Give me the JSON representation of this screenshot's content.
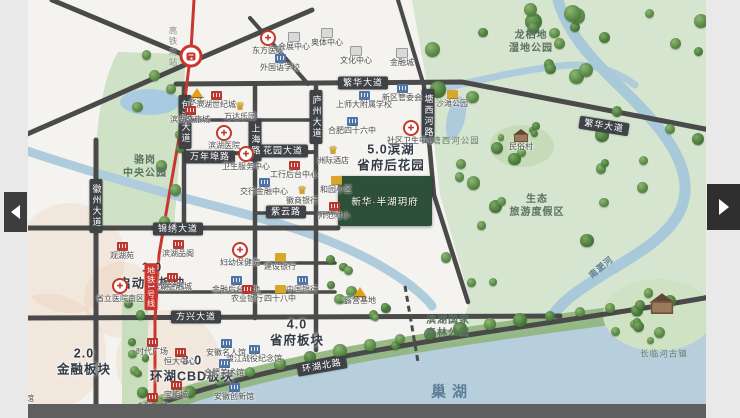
{
  "carousel": {
    "prev_name": "previous-slide",
    "next_name": "next-slide"
  },
  "colors": {
    "road": "#4a4a4a",
    "metro": "#c9362e",
    "water": "#b7cfdd",
    "park": "#d6e5cf",
    "plate": "#3f4347",
    "accent_red": "#b9372c"
  },
  "map": {
    "metro": {
      "station_label": "高铁南站",
      "station_x": 191,
      "station_y": 56,
      "label_x": 173,
      "label_y": 26,
      "line_badge": "地铁1号线",
      "badge_x": 151,
      "badge_y": 287
    },
    "project": {
      "name": "新华·半湖玥府"
    },
    "road_labels": [
      {
        "text": "繁华大道",
        "x": 363,
        "y": 83,
        "vert": false,
        "rot": 0
      },
      {
        "text": "繁华大道",
        "x": 604,
        "y": 126,
        "vert": false,
        "rot": 9
      },
      {
        "text": "锦绣大道",
        "x": 178,
        "y": 229,
        "vert": false,
        "rot": 0
      },
      {
        "text": "方兴大道",
        "x": 196,
        "y": 317,
        "vert": false,
        "rot": 0
      },
      {
        "text": "万年埠路",
        "x": 210,
        "y": 157,
        "vert": false,
        "rot": 0
      },
      {
        "text": "花园大道",
        "x": 283,
        "y": 151,
        "vert": false,
        "rot": 0
      },
      {
        "text": "紫云路",
        "x": 286,
        "y": 212,
        "vert": false,
        "rot": 0
      },
      {
        "text": "环湖北路",
        "x": 322,
        "y": 366,
        "vert": false,
        "rot": -10
      },
      {
        "text": "徽州大道",
        "x": 96,
        "y": 206,
        "vert": true,
        "rot": 0
      },
      {
        "text": "包河大道",
        "x": 185,
        "y": 122,
        "vert": true,
        "rot": 0
      },
      {
        "text": "上海路",
        "x": 255,
        "y": 140,
        "vert": true,
        "rot": 0
      },
      {
        "text": "庐州大道",
        "x": 316,
        "y": 117,
        "vert": true,
        "rot": 0
      },
      {
        "text": "塘西河路",
        "x": 428,
        "y": 116,
        "vert": true,
        "rot": 0
      }
    ],
    "sections": [
      {
        "text": "1.0\n启动区板块",
        "x": 152,
        "y": 276
      },
      {
        "text": "2.0\n金融板块",
        "x": 84,
        "y": 362
      },
      {
        "text": "3.0\n环湖CBD板块",
        "x": 192,
        "y": 369
      },
      {
        "text": "4.0\n省府板块",
        "x": 297,
        "y": 333
      },
      {
        "text": "5.0滨湖\n省府后花园",
        "x": 391,
        "y": 158
      }
    ],
    "park_labels": [
      {
        "text": "骆岗\n中央公园",
        "x": 145,
        "y": 167,
        "small": false
      },
      {
        "text": "龙栖地\n湿地公园",
        "x": 531,
        "y": 42,
        "small": false
      },
      {
        "text": "塘西河公园",
        "x": 456,
        "y": 141,
        "small": true
      },
      {
        "text": "生态\n旅游度假区",
        "x": 537,
        "y": 206,
        "small": false
      },
      {
        "text": "滨湖国家\n森林公园",
        "x": 448,
        "y": 327,
        "small": false
      },
      {
        "text": "长临河古镇",
        "x": 664,
        "y": 354,
        "small": true
      }
    ],
    "water_labels": [
      {
        "text": "巢湖",
        "x": 452,
        "y": 391,
        "size": 15,
        "ls": 6,
        "rot": 0
      },
      {
        "text": "南淝河",
        "x": 601,
        "y": 267,
        "size": 8.5,
        "ls": 1,
        "rot": -40
      }
    ],
    "pois": [
      {
        "t": "hospital",
        "n": "东方医院",
        "x": 268,
        "y": 34
      },
      {
        "t": "gray",
        "n": "会展中心",
        "x": 294,
        "y": 36
      },
      {
        "t": "gray",
        "n": "奥体中心",
        "x": 327,
        "y": 32
      },
      {
        "t": "gray",
        "n": "文化中心",
        "x": 356,
        "y": 50
      },
      {
        "t": "gray",
        "n": "金融城",
        "x": 402,
        "y": 52
      },
      {
        "t": "blue",
        "n": "外国语学校",
        "x": 280,
        "y": 58
      },
      {
        "t": "tent",
        "n": "水街",
        "x": 197,
        "y": 92
      },
      {
        "t": "red",
        "n": "滨湖世纪城",
        "x": 216,
        "y": 95
      },
      {
        "t": "red",
        "n": "滨湖文旅城",
        "x": 190,
        "y": 110
      },
      {
        "t": "crown",
        "n": "万达乐园",
        "x": 240,
        "y": 106
      },
      {
        "t": "hospital",
        "n": "滨湖医院",
        "x": 224,
        "y": 129
      },
      {
        "t": "hospital",
        "n": "卫生服务中心",
        "x": 246,
        "y": 150
      },
      {
        "t": "red",
        "n": "工行后台中心",
        "x": 294,
        "y": 165
      },
      {
        "t": "blue",
        "n": "交行金融中心",
        "x": 264,
        "y": 182
      },
      {
        "t": "crown",
        "n": "徽商银行",
        "x": 302,
        "y": 190
      },
      {
        "t": "blue",
        "n": "合肥四十六中",
        "x": 352,
        "y": 121
      },
      {
        "t": "blue",
        "n": "上师大附属学校",
        "x": 364,
        "y": 95
      },
      {
        "t": "blue",
        "n": "新区管委会",
        "x": 402,
        "y": 88
      },
      {
        "t": "hospital",
        "n": "社区卫生中心",
        "x": 411,
        "y": 124
      },
      {
        "t": "crown",
        "n": "洲际酒店",
        "x": 333,
        "y": 150
      },
      {
        "t": "gold",
        "n": "和园小区",
        "x": 336,
        "y": 180
      },
      {
        "t": "red",
        "n": "师范附小",
        "x": 334,
        "y": 206
      },
      {
        "t": "red",
        "n": "观湖苑",
        "x": 122,
        "y": 246
      },
      {
        "t": "red",
        "n": "滨湖品阁",
        "x": 178,
        "y": 244
      },
      {
        "t": "hospital",
        "n": "省立医院南区",
        "x": 120,
        "y": 282
      },
      {
        "t": "red",
        "n": "滨湖金融城",
        "x": 172,
        "y": 277
      },
      {
        "t": "blue",
        "n": "金融后台基地",
        "x": 236,
        "y": 280
      },
      {
        "t": "hospital",
        "n": "妇幼保健院",
        "x": 240,
        "y": 246
      },
      {
        "t": "gold",
        "n": "建设银行",
        "x": 280,
        "y": 257
      },
      {
        "t": "blue",
        "n": "中国银行",
        "x": 302,
        "y": 280
      },
      {
        "t": "red",
        "n": "农业银行",
        "x": 247,
        "y": 289
      },
      {
        "t": "gold",
        "n": "四十八中",
        "x": 280,
        "y": 289
      },
      {
        "t": "tent",
        "n": "露营基地",
        "x": 360,
        "y": 291
      },
      {
        "t": "red",
        "n": "时代广场",
        "x": 152,
        "y": 342
      },
      {
        "t": "red",
        "n": "恒大中心",
        "x": 180,
        "y": 352
      },
      {
        "t": "red",
        "n": "宝能城",
        "x": 176,
        "y": 385
      },
      {
        "t": "red",
        "n": "金融小镇",
        "x": 152,
        "y": 397
      },
      {
        "t": "blue",
        "n": "安徽名人馆",
        "x": 226,
        "y": 343
      },
      {
        "t": "blue",
        "n": "渡江战役纪念馆",
        "x": 254,
        "y": 349
      },
      {
        "t": "blue",
        "n": "合肥美术馆",
        "x": 224,
        "y": 363
      },
      {
        "t": "blue",
        "n": "安徽创新馆",
        "x": 234,
        "y": 387
      },
      {
        "t": "gold",
        "n": "沙滩公园",
        "x": 452,
        "y": 94
      },
      {
        "t": "gray",
        "n": "规划场馆",
        "x": 18,
        "y": 388
      },
      {
        "t": "house",
        "n": "民俗村",
        "x": 521,
        "y": 133
      },
      {
        "t": "house-big",
        "n": "长临河古镇",
        "x": 662,
        "y": 305,
        "nolabel": true
      }
    ]
  }
}
